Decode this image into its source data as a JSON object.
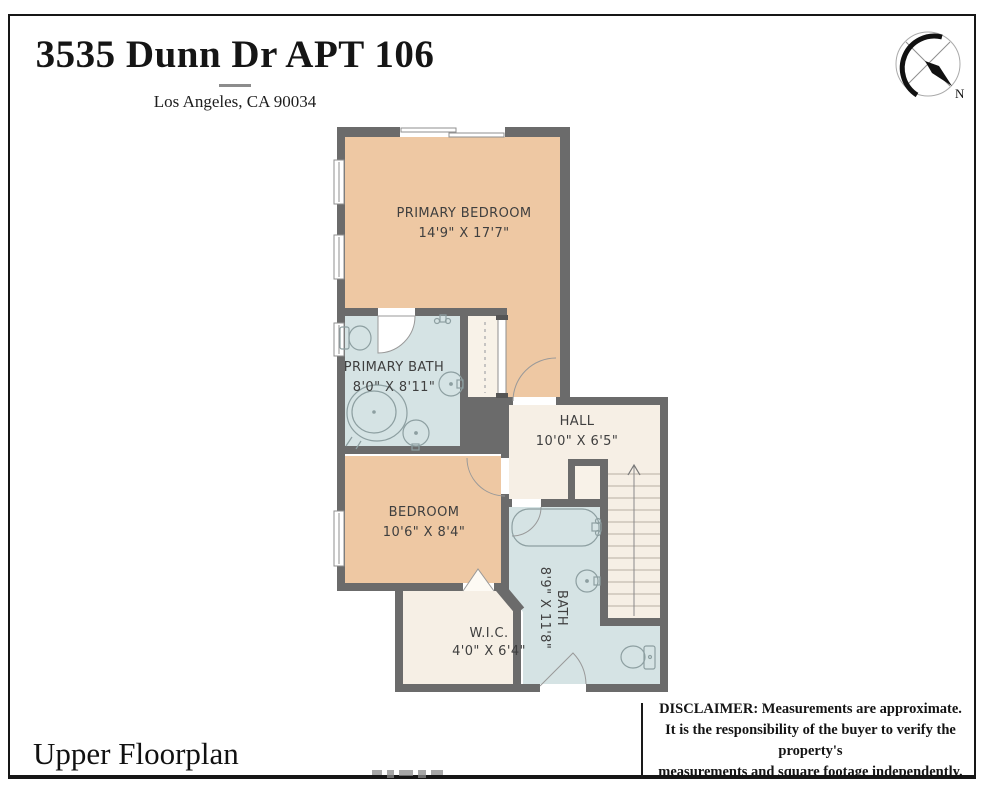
{
  "header": {
    "title": "3535 Dunn Dr APT 106",
    "subtitle": "Los Angeles, CA 90034"
  },
  "compass": {
    "north_label": "N"
  },
  "rooms": {
    "primary_bedroom": {
      "name": "PRIMARY BEDROOM",
      "dims": "14'9\" X 17'7\""
    },
    "primary_bath": {
      "name": "PRIMARY BATH",
      "dims": "8'0\" X 8'11\""
    },
    "hall": {
      "name": "HALL",
      "dims": "10'0\" X 6'5\""
    },
    "bedroom": {
      "name": "BEDROOM",
      "dims": "10'6\" X 8'4\""
    },
    "bath": {
      "name": "BATH",
      "dims": "8'9\" X 11'8\""
    },
    "wic": {
      "name": "W.I.C.",
      "dims": "4'0\" X 6'4\""
    }
  },
  "footer": {
    "plan_label": "Upper Floorplan",
    "disclaimer": [
      "DISCLAIMER: Measurements are approximate.",
      "It is the responsibility of the buyer to verify the property's",
      "measurements and square footage independently."
    ]
  },
  "colors": {
    "wall": "#6b6b6b",
    "bedroom_fill": "#eec8a3",
    "bath_fill": "#d5e3e4",
    "hall_fill": "#f6efe5",
    "closet_fill": "#f8f2e8",
    "fixture_stroke": "#8d9fa1",
    "stair_line": "#b8afa2"
  }
}
